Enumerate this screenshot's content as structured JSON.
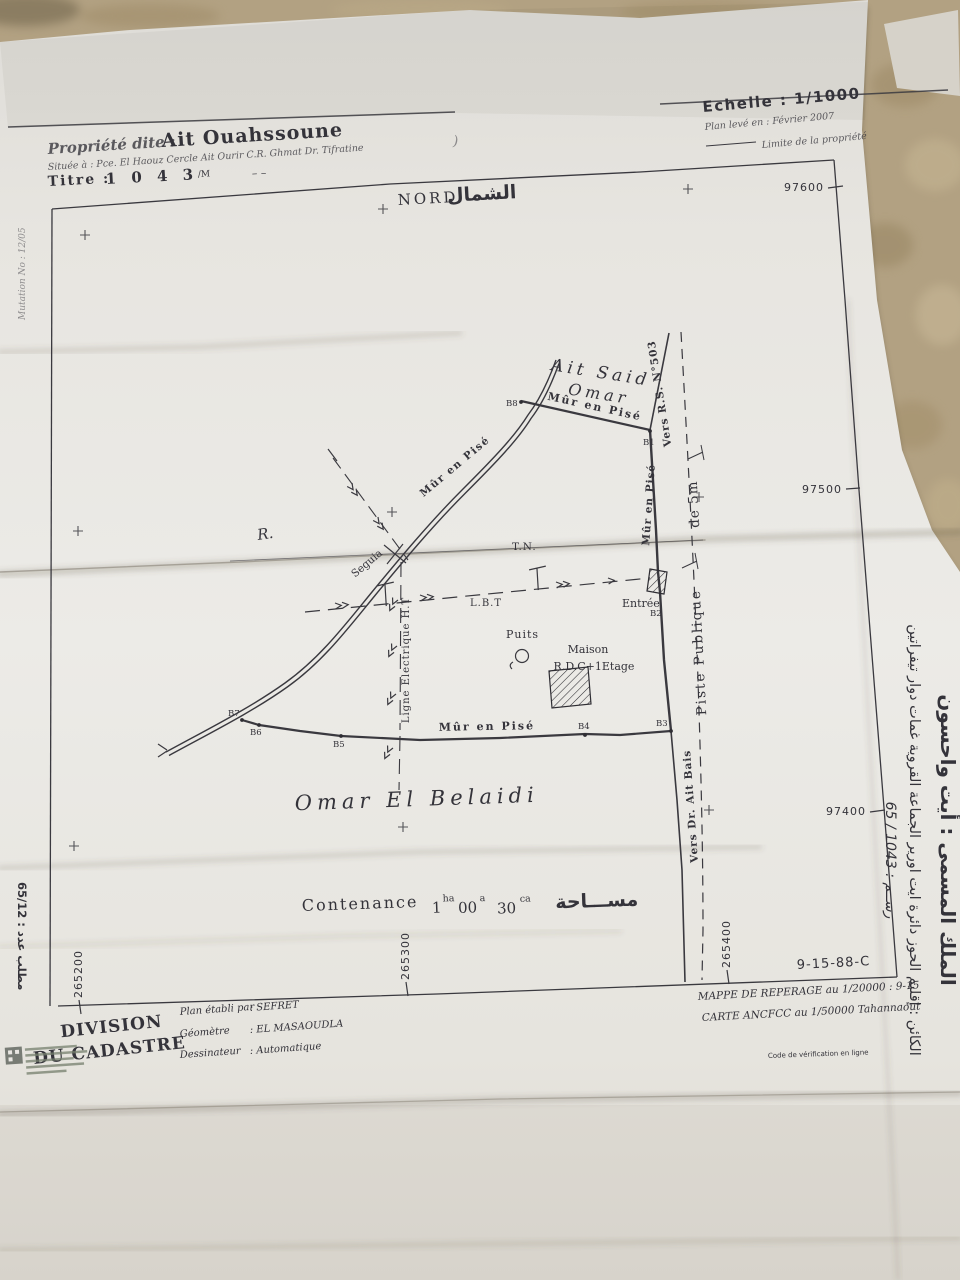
{
  "colors": {
    "carpet": "#b2a182",
    "paper": "#e9e7e2",
    "ink": "#34333a"
  },
  "header": {
    "propriete_label": "Propriété dite :",
    "propriete_value": "Ait Ouahssoune",
    "situee": "Située à : Pce. El Haouz Cercle Ait Ourir C.R. Ghmat Dr. Tifratine",
    "titre_label": "Titre :",
    "titre_value": "1 0 4 3",
    "titre_suffix": "/M",
    "titre_dashes": "– –",
    "echelle": "Echelle : 1/1000",
    "plan_leve": "Plan levé en : Février 2007",
    "limite": "Limite de la propriété",
    "nord": "NORD",
    "nord_ar": "الشمال",
    "paren_mark": ")"
  },
  "grid": {
    "y1": "97600",
    "y2": "97500",
    "y3": "97400",
    "x1": "265200",
    "x2": "265300",
    "x3": "265400"
  },
  "parcel": {
    "points": {
      "b1": "B1",
      "b2": "B2",
      "b3": "B3",
      "b4": "B4",
      "b5": "B5",
      "b6": "B6",
      "b7": "B7",
      "b8": "B8"
    },
    "wall_top": "Mûr en Pisé",
    "wall_right": "Mûr en Pisé",
    "wall_bottom": "Mûr en Pisé",
    "wall_nw": "Mûr en Pisé",
    "entree": "Entrée",
    "vers_rs": "Vers R.S. N°503",
    "vers_dr": "Vers Dr. Ait Bais",
    "piste_1": "Piste Publique",
    "piste_2": "de 5m",
    "seguia": "Seguia",
    "riviere": "R.",
    "tn": "T.N.",
    "lbt": "L.B.T",
    "ligne_ht": "Ligne Electrique H.T",
    "puits": "Puits",
    "maison_1": "Maison",
    "maison_2": "R.D.C+1Etage",
    "neighbor_north_1": "Ait Said",
    "neighbor_north_2": "Omar",
    "neighbor_south": "Omar El Belaidi"
  },
  "contenance": {
    "label": "Contenance",
    "v1": "1",
    "u1": "ha",
    "v2": "00",
    "u2": "a",
    "v3": "30",
    "u3": "ca",
    "arabic": "مســـاحة"
  },
  "footer": {
    "division_1": "DIVISION",
    "division_2": "DU CADASTRE",
    "etabli_label": "Plan établi par",
    "etabli_value": ": SEFRET",
    "geometre_label": "Géomètre",
    "geometre_value": ": EL MASAOUDLA",
    "dessinateur_label": "Dessinateur",
    "dessinateur_value": ": Automatique",
    "ref": "9-15-88-C",
    "mappe": "MAPPE DE REPERAGE au 1/20000 : 9-15",
    "carte": "CARTE ANCFCC au 1/50000 Tahannaout",
    "verification": "Code de vérification en ligne"
  },
  "margins": {
    "left_top": "Mutation No : 12/05",
    "left_bottom": "مطلب عدد : 65/12",
    "right_1": "الملك المسمى : أيت واحسون",
    "right_2": "الكائن : إقليم الحوز دائرة ايت اورير الجماعة القروية غمات دوار تيفراتين",
    "right_3": "رســم : 1043 / 65"
  }
}
